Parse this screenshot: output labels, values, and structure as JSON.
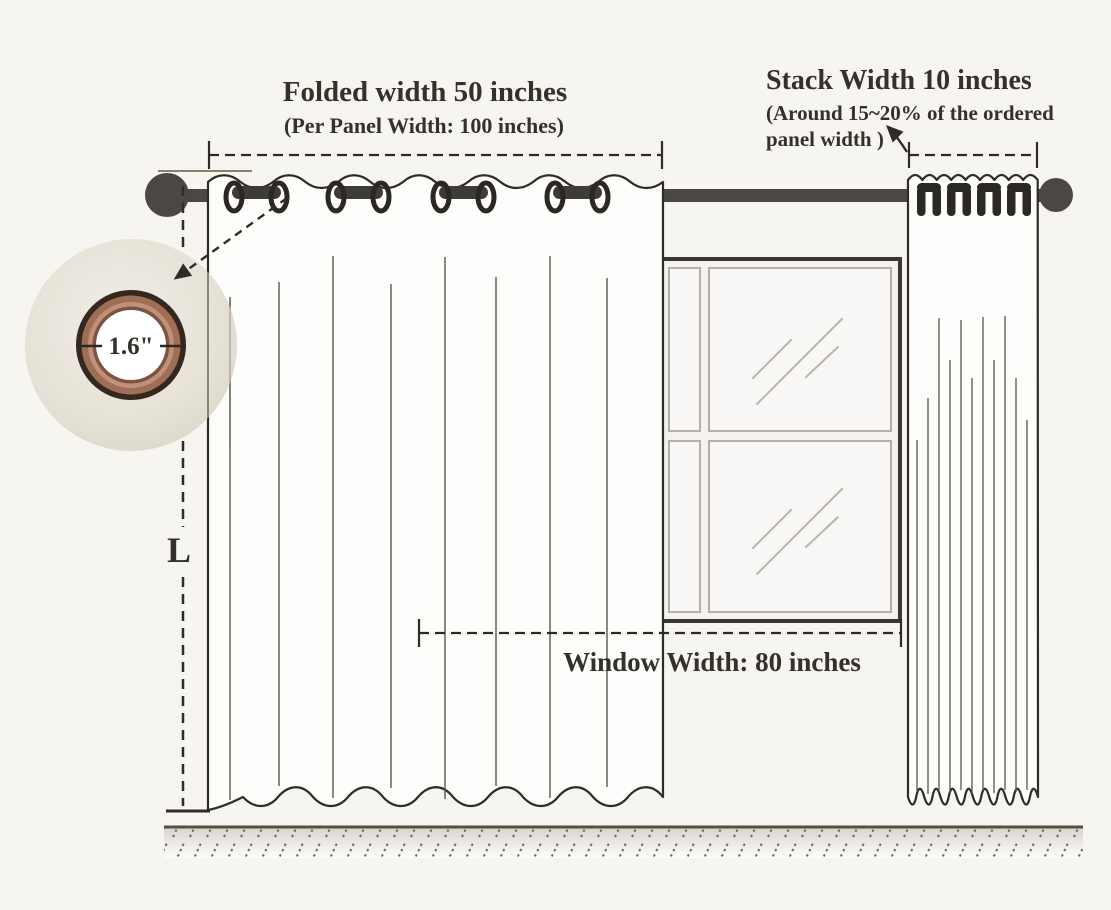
{
  "page": {
    "background": "#f7f5f0"
  },
  "labels": {
    "folded_width_title": "Folded width 50 inches",
    "folded_width_subtitle": "(Per Panel Width: 100 inches)",
    "stack_width_title": "Stack Width 10 inches",
    "stack_width_subtitle_line1": "(Around 15~20% of the ordered",
    "stack_width_subtitle_line2": "panel width )",
    "window_width_label": "Window Width: 80 inches",
    "length_label": "L",
    "grommet_inner_diameter_label": "1.6\""
  },
  "measurements": {
    "folded_width_inches": 50,
    "per_panel_width_inches": 100,
    "stack_width_inches": 10,
    "stack_width_percent_of_panel": "15~20%",
    "window_width_inches": 80,
    "grommet_inner_diameter_inches": 1.6
  },
  "colors": {
    "ink": "#34302a",
    "outline": "#2f2b26",
    "rod": "#4b4743",
    "fold_line": "#5a564e",
    "window_frame": "#3b3833",
    "pane_border": "#b3b0aa",
    "fabric_circle": "#e5e0d5",
    "grommet_copper": "#9e6e55",
    "floor_hatch": "#6e6a60"
  }
}
